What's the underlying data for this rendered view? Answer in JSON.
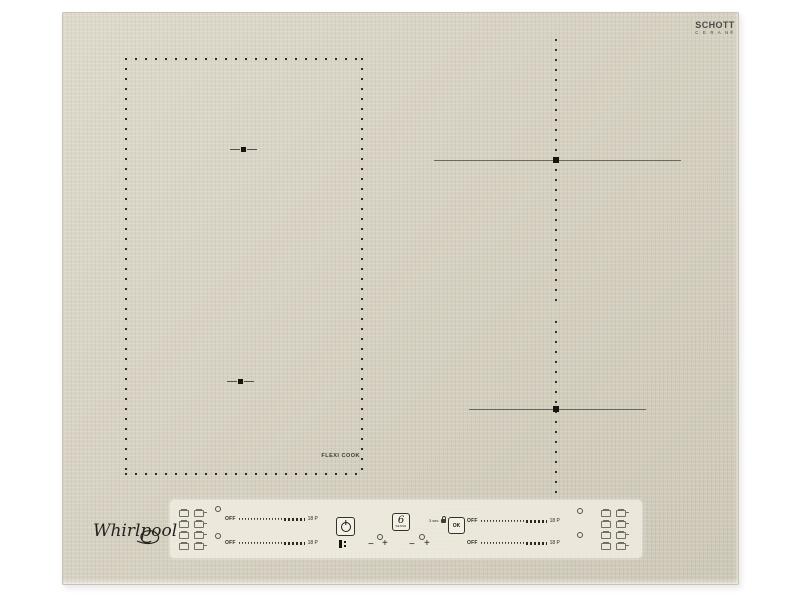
{
  "brand": {
    "name": "Whirlpool"
  },
  "glass_logo": {
    "line1": "SCHOTT",
    "line2": "C E R A N®"
  },
  "surface": {
    "flexi_label": "FLEXI COOK"
  },
  "control_panel": {
    "left_sliders": [
      {
        "off_label": "OFF",
        "level_label": "18 P"
      },
      {
        "off_label": "OFF",
        "level_label": "18 P"
      }
    ],
    "right_sliders": [
      {
        "off_label": "OFF",
        "level_label": "18 P"
      },
      {
        "off_label": "OFF",
        "level_label": "18 P"
      }
    ],
    "sense_logo": {
      "digit": "6",
      "caption": "SENSE"
    },
    "hold_label": "3 sec",
    "ok_label": "OK",
    "minus_label": "−",
    "plus_label": "+"
  },
  "colors": {
    "surface": "#d6d0bf",
    "panel": "#f0ecdf",
    "marking": "#2c2c28",
    "background": "#ffffff"
  }
}
